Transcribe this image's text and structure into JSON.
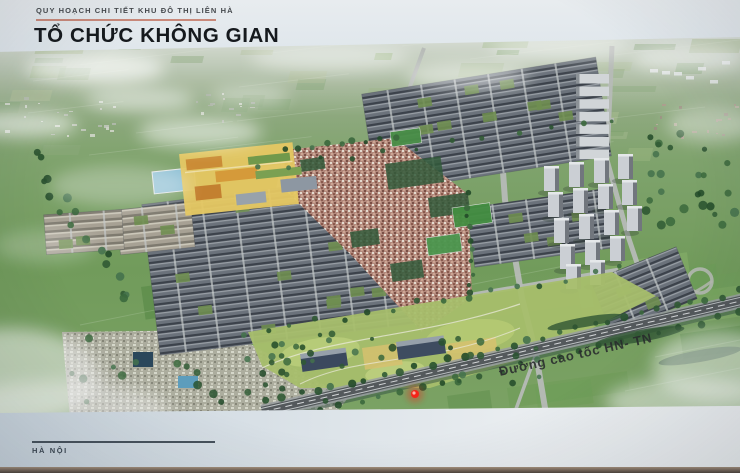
{
  "poster": {
    "kicker": "QUY HOẠCH CHI TIẾT KHU ĐÔ THỊ LIÊN HÀ",
    "title": "TỔ CHỨC KHÔNG GIAN",
    "footer_location": "HÀ NỘI",
    "accent_color": "#c9897a",
    "board_color": "#d4dee5"
  },
  "masterplan": {
    "highway_label": "Đường cao tốc HN- TN",
    "marker": {
      "name": "laser-pointer-dot",
      "color": "#ff2014"
    },
    "palette": {
      "field_green": "#6f9c58",
      "field_light": "#9db982",
      "rowhouse_roof": "#4a525a",
      "village_roof": "#b5897b",
      "tower_gray": "#ccd1d6",
      "road_gray": "#b7bcb8",
      "highway_dark": "#53585c",
      "campus_yellow": "#e9c95c",
      "park_green": "#a6c067",
      "tree_green": "#2d5a31"
    }
  }
}
